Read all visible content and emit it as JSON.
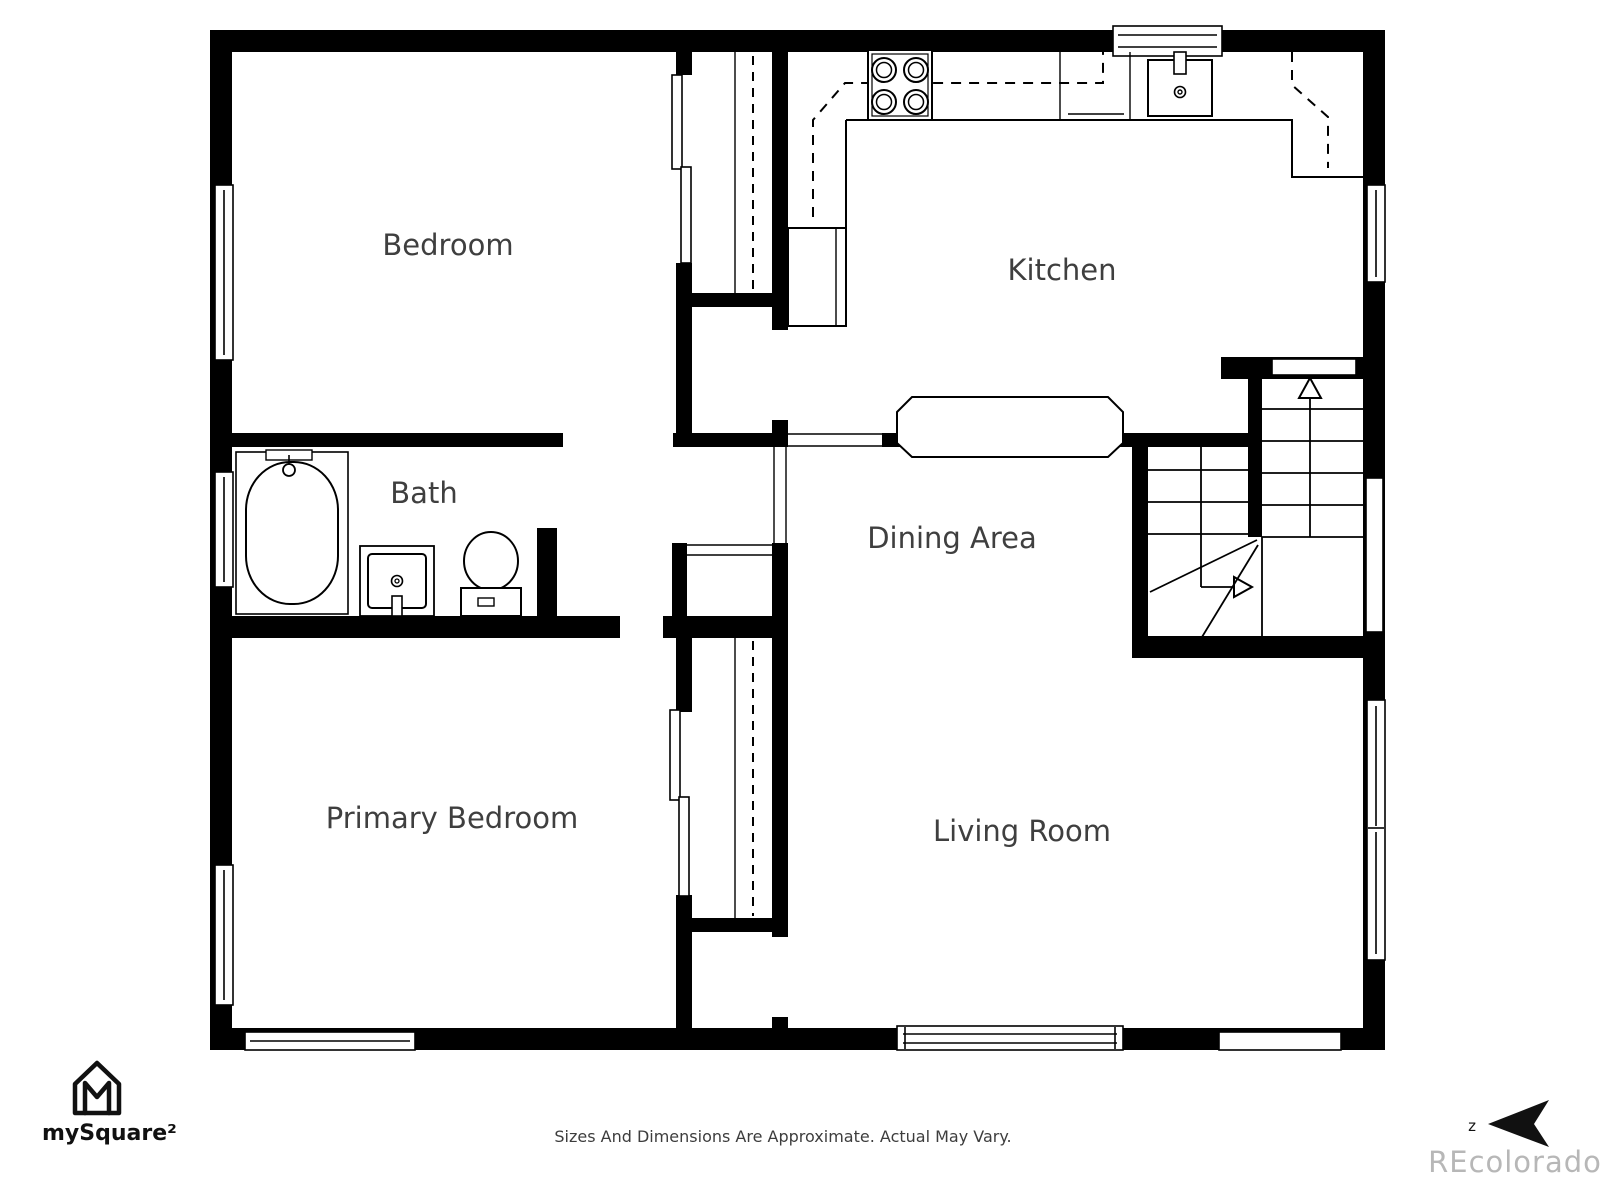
{
  "rooms": [
    {
      "label": "Bedroom"
    },
    {
      "label": "Kitchen"
    },
    {
      "label": "Bath"
    },
    {
      "label": "Dining Area"
    },
    {
      "label": "Primary Bedroom"
    },
    {
      "label": "Living Room"
    }
  ],
  "branding": {
    "logo_text": "mySquare²"
  },
  "footer": {
    "disclaimer": "Sizes And Dimensions Are Approximate. Actual May Vary."
  },
  "watermark": {
    "text": "REcolorado"
  },
  "compass": {
    "label": "z"
  },
  "colors": {
    "wall": "#000000",
    "line": "#1a1a1a",
    "label": "#3f3f3f",
    "disclaimer": "#3d3d3d",
    "watermark": "#b7b7b7",
    "logo": "#111111"
  }
}
